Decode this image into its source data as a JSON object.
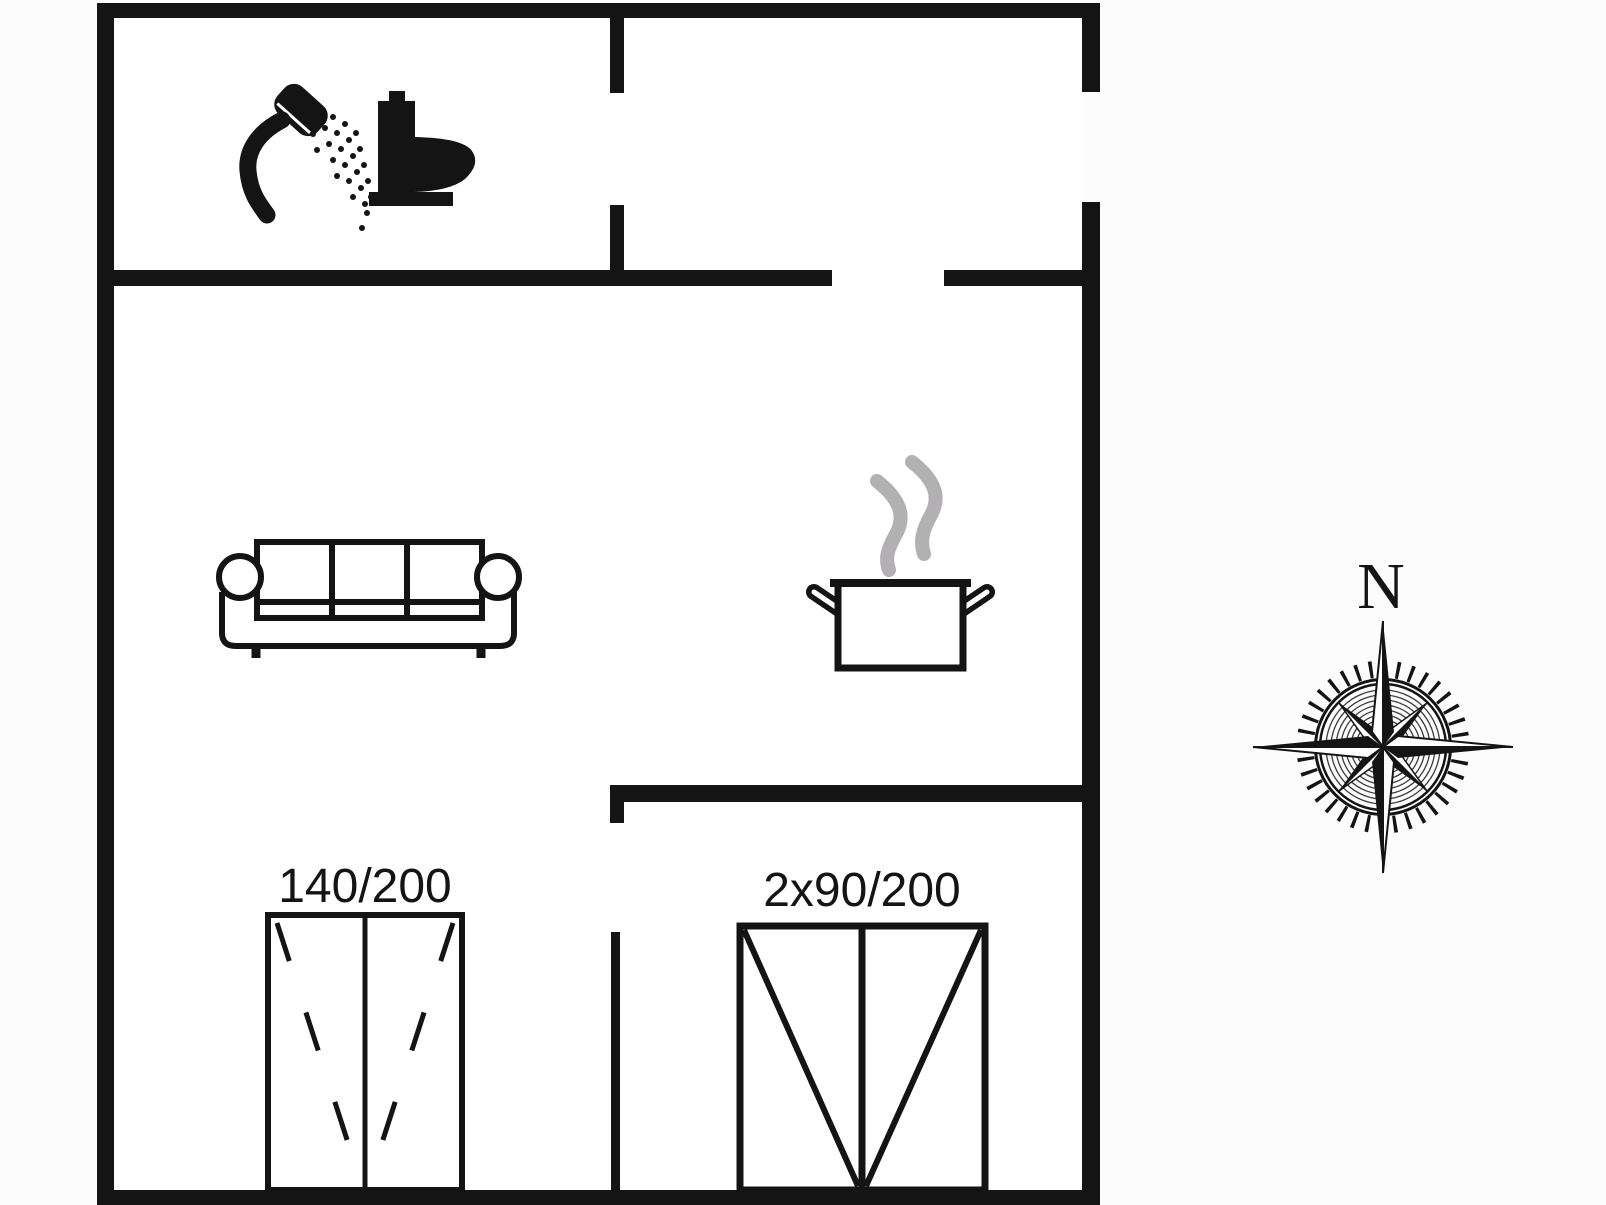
{
  "document": {
    "type": "floor-plan",
    "colors": {
      "wall": "#141414",
      "floor": "#ffffff",
      "paper": "#fcfcfc",
      "steam": "#b2b0b2"
    }
  },
  "plan": {
    "bathroom": {
      "icons": [
        "shower-icon",
        "toilet-icon"
      ]
    },
    "living_room": {
      "icons": [
        "sofa-icon"
      ]
    },
    "kitchen": {
      "icons": [
        "cooking-pot-icon",
        "steam-icon"
      ]
    },
    "bedroom_double": {
      "bed_label": "140/200",
      "icon": "double-bed-icon"
    },
    "bedroom_twin": {
      "bed_label": "2x90/200",
      "icon": "twin-beds-icon"
    }
  },
  "compass": {
    "north_label": "N",
    "icon": "compass-rose-icon"
  }
}
